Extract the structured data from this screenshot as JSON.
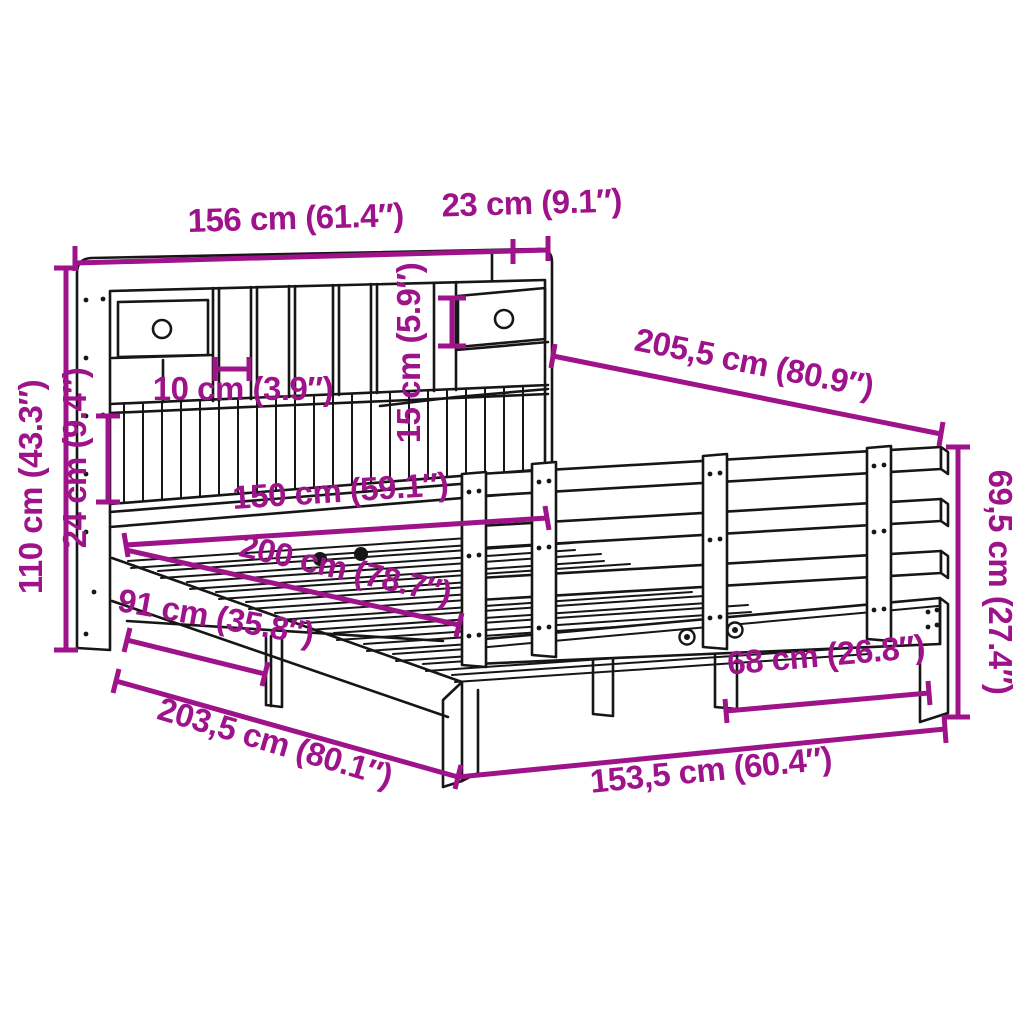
{
  "diagram": {
    "subject": "bookcase-bed-with-headboard-shelves-dimension-drawing",
    "background": "#ffffff",
    "accent_color": "#9E138A",
    "line_color": "#161616",
    "dimensions": {
      "headboard_width": "156 cm (61.4″)",
      "headboard_depth": "23 cm (9.1″)",
      "headboard_height": "110 cm (43.3″)",
      "shelf_section_height": "24 cm (9.4″)",
      "cubby_width": "10 cm (3.9″)",
      "drawer_height": "15 cm (5.9″)",
      "total_length": "205,5 cm (80.9″)",
      "footboard_height": "69,5 cm (27.4″)",
      "bed_width": "150 cm (59.1″)",
      "bed_length": "200 cm (78.7″)",
      "side_clearance": "91 cm (35.8″)",
      "foot_clearance": "68 cm (26.8″)",
      "frame_length": "203,5 cm (80.1″)",
      "frame_width": "153,5 cm (60.4″)"
    }
  }
}
